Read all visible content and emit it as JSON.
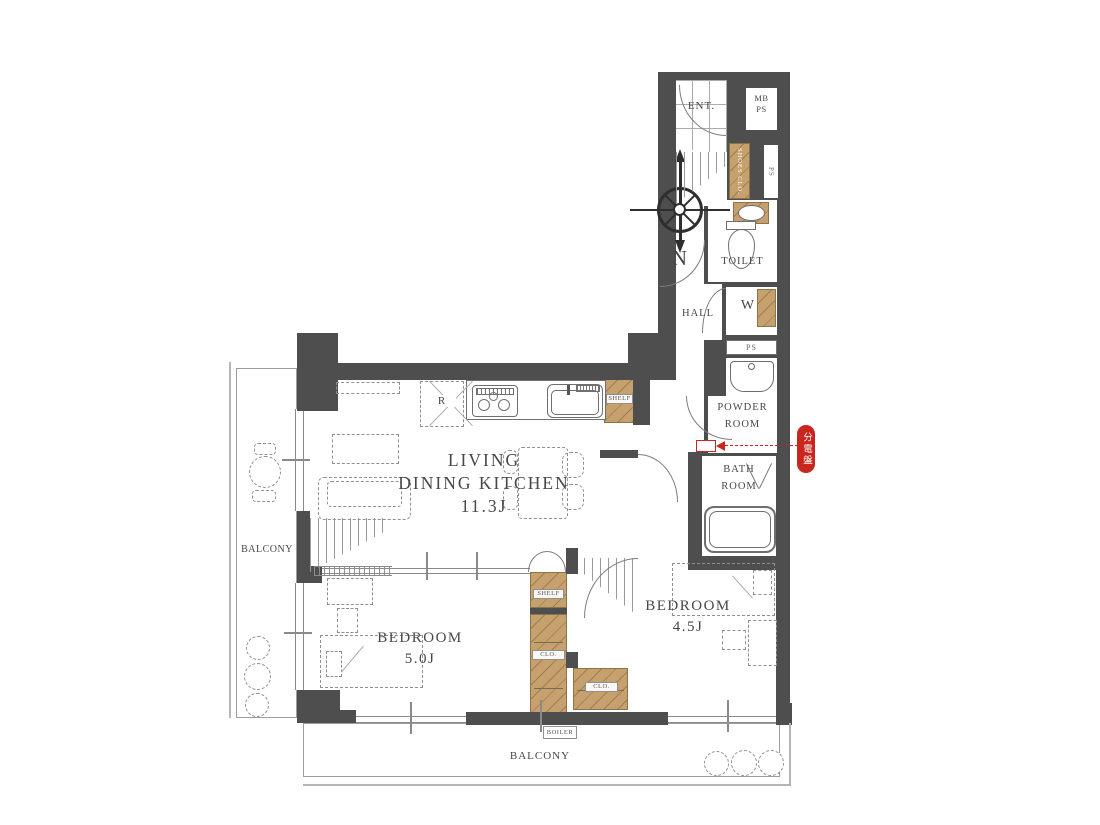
{
  "compass": {
    "north": "N"
  },
  "colors": {
    "wall": "#4f4e4e",
    "cabinet_tan": "#c6a06d",
    "accent_red": "#c9261d",
    "line_gray": "#8a8a8a"
  },
  "rooms": {
    "entrance": "ENT.",
    "mb_ps": {
      "l1": "MB",
      "l2": "PS"
    },
    "ps_top": "PS",
    "shoes_closet": "SHOES CLO.",
    "toilet": "TOILET",
    "hall": "HALL",
    "washer": "W",
    "ps_mid": "PS",
    "powder": {
      "l1": "POWDER",
      "l2": "ROOM"
    },
    "bath": {
      "l1": "BATH",
      "l2": "ROOM"
    },
    "ldk": {
      "l1": "LIVING",
      "l2": "DINING KITCHEN",
      "l3": "11.3J"
    },
    "bedroom_main": {
      "l1": "BEDROOM",
      "l2": "5.0J"
    },
    "bedroom_second": {
      "l1": "BEDROOM",
      "l2": "4.5J"
    },
    "balcony_left": "BALCONY",
    "balcony_bottom": "BALCONY"
  },
  "storage": {
    "shelf_kitchen": "SHELF",
    "shelf_center": "SHELF",
    "clo_center": "CLO.",
    "clo_second": "CLO.",
    "boiler": "BOILER"
  },
  "kitchen": {
    "fridge": "R"
  },
  "annotations": {
    "distribution_board": "分電盤"
  }
}
